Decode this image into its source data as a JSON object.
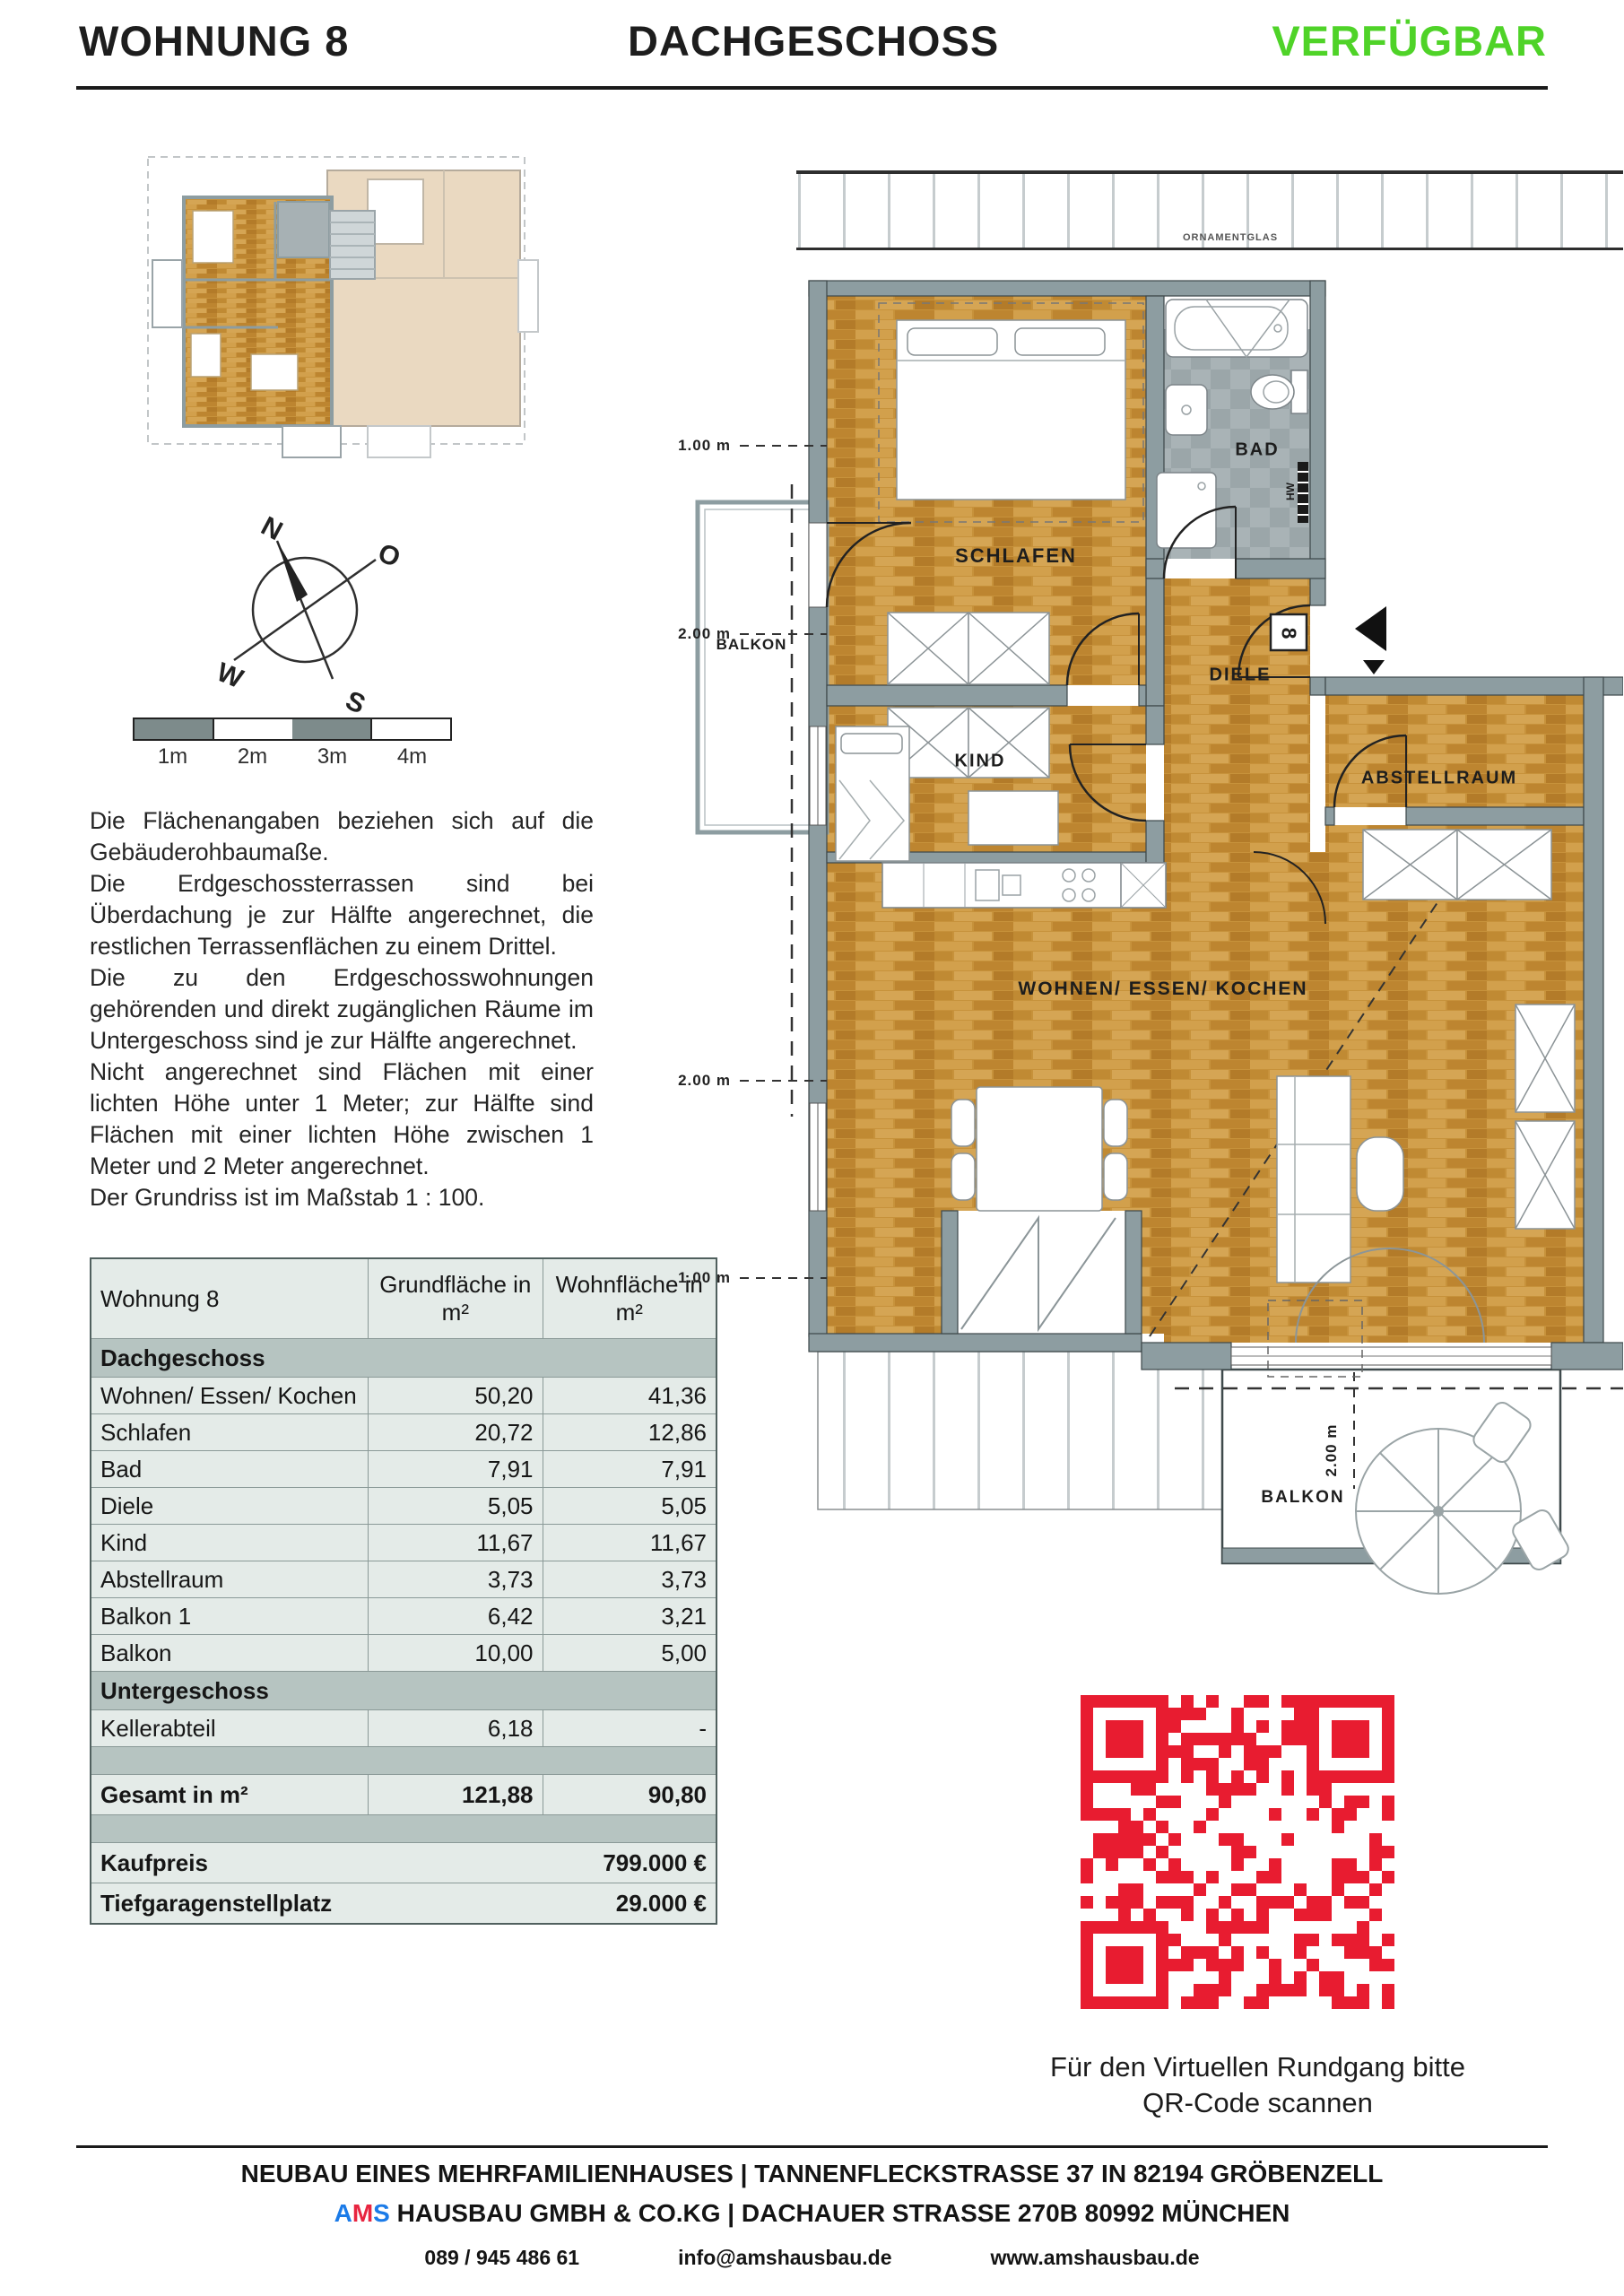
{
  "header": {
    "apartment": "WOHNUNG 8",
    "floor": "DACHGESCHOSS",
    "status": "VERFÜGBAR",
    "status_color": "#4fd328"
  },
  "compass": {
    "n": "N",
    "o": "O",
    "w": "W",
    "s": "S"
  },
  "scalebar": {
    "l1": "1m",
    "l2": "2m",
    "l3": "3m",
    "l4": "4m"
  },
  "notes": "Die Flächenangaben beziehen sich auf die Gebäuderohbaumaße.\nDie Erdgeschossterrassen sind bei Überdachung je zur Hälfte angerechnet, die restlichen Terrassenflächen zu einem Drittel.\nDie zu den Erdgeschosswohnungen gehörenden und direkt zugänglichen Räume im Untergeschoss sind je zur Hälfte angerechnet.\nNicht angerechnet sind Flächen mit einer lichten Höhe unter 1 Meter; zur Hälfte sind Flächen mit einer lichten Höhe zwischen 1 Meter und 2 Meter angerechnet.\nDer Grundriss ist im Maßstab 1 : 100.",
  "plan": {
    "rooms": {
      "schlafen": "SCHLAFEN",
      "bad": "BAD",
      "diele": "DIELE",
      "kind": "KIND",
      "abstellraum": "ABSTELLRAUM",
      "wohnen": "WOHNEN/ ESSEN/ KOCHEN",
      "balkon_left": "BALKON",
      "balkon_bottom": "BALKON"
    },
    "labels": {
      "ornamentglas": "ORNAMENTGLAS",
      "hw": "HW",
      "unit_badge": "8"
    },
    "dims": {
      "d1": "1.00 m",
      "d2": "2.00 m",
      "d3": "2.00 m",
      "d4": "1.00 m",
      "d5": "2.00 m"
    }
  },
  "table": {
    "col1_header": "Wohnung 8",
    "col2_header": "Grundfläche in m²",
    "col3_header": "Wohnfläche in m²",
    "section1": "Dachgeschoss",
    "rows": [
      {
        "label": "Wohnen/ Essen/ Kochen",
        "grund": "50,20",
        "wohn": "41,36"
      },
      {
        "label": "Schlafen",
        "grund": "20,72",
        "wohn": "12,86"
      },
      {
        "label": "Bad",
        "grund": "7,91",
        "wohn": "7,91"
      },
      {
        "label": "Diele",
        "grund": "5,05",
        "wohn": "5,05"
      },
      {
        "label": "Kind",
        "grund": "11,67",
        "wohn": "11,67"
      },
      {
        "label": "Abstellraum",
        "grund": "3,73",
        "wohn": "3,73"
      },
      {
        "label": "Balkon 1",
        "grund": "6,42",
        "wohn": "3,21"
      },
      {
        "label": "Balkon",
        "grund": "10,00",
        "wohn": "5,00"
      }
    ],
    "section2": "Untergeschoss",
    "rows2": [
      {
        "label": "Kellerabteil",
        "grund": "6,18",
        "wohn": "-"
      }
    ],
    "total": {
      "label": "Gesamt in m²",
      "grund": "121,88",
      "wohn": "90,80"
    },
    "price": {
      "label": "Kaufpreis",
      "value": "799.000 €"
    },
    "garage": {
      "label": "Tiefgaragenstellplatz",
      "value": "29.000 €"
    }
  },
  "qr": {
    "color": "#e81c30",
    "caption_line1": "Für den Virtuellen Rundgang bitte",
    "caption_line2": "QR-Code scannen"
  },
  "footer": {
    "line1": "NEUBAU EINES MEHRFAMILIENHAUSES | TANNENFLECKSTRASSE 37 IN 82194 GRÖBENZELL",
    "ams_a": "A",
    "ams_m": "M",
    "ams_s": "S",
    "company_rest": " HAUSBAU GMBH & CO.KG | DACHAUER STRASSE 270B 80992 MÜNCHEN",
    "phone": "089 / 945 486 61",
    "email": "info@amshausbau.de",
    "website": "www.amshausbau.de"
  }
}
